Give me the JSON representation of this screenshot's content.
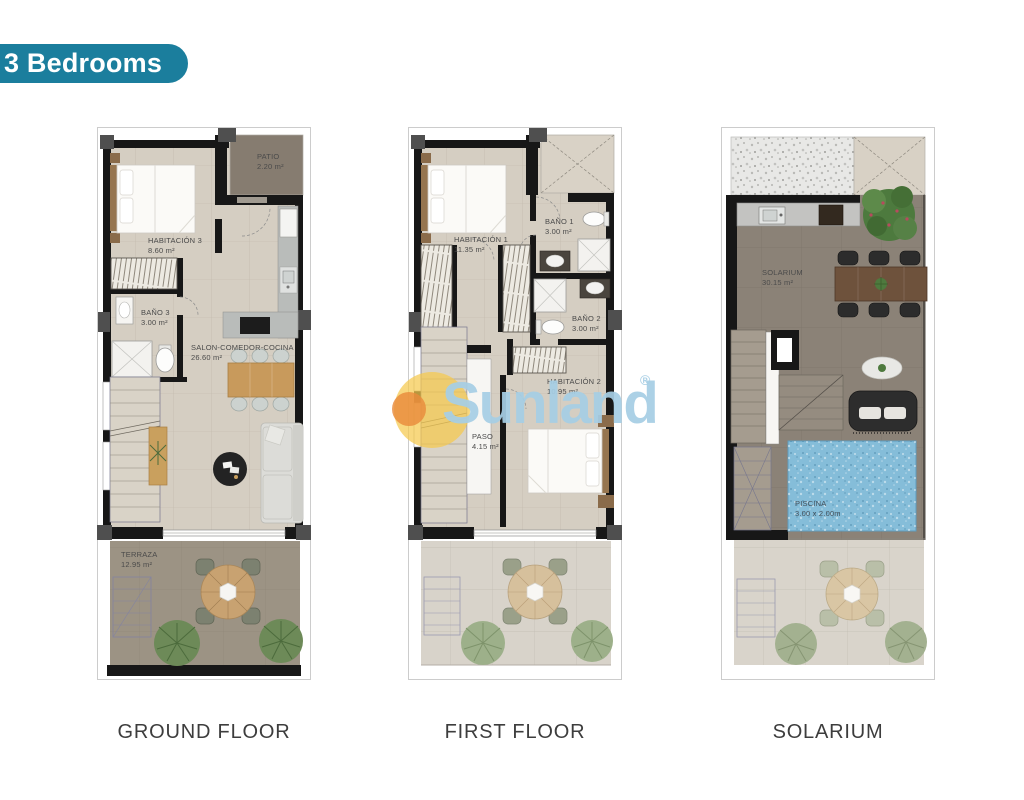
{
  "page": {
    "title_badge": "3 Bedrooms"
  },
  "watermark": {
    "text": "Sunland",
    "registered_mark": "®"
  },
  "colors": {
    "badge": "#1b7e9d",
    "watermark_text": "#a6cee4",
    "logo_yellow": "#f5c94e",
    "logo_orange": "#e98b3c",
    "pool_water": "#85bdd9",
    "wall": "#171717",
    "floor_interior": "#d5cec2",
    "floor_patio": "#867c70",
    "floor_terrace": "#9c9384",
    "floor_solarium": "#8b8277"
  },
  "plans": [
    {
      "id": "ground-floor",
      "caption": "GROUND FLOOR",
      "rooms": [
        {
          "name": "PATIO",
          "area": "2.20 m²"
        },
        {
          "name": "HABITACIÓN 3",
          "area": "8.60 m²"
        },
        {
          "name": "BAÑO 3",
          "area": "3.00 m²"
        },
        {
          "name": "SALON-COMEDOR-COCINA",
          "area": "26.60 m²"
        },
        {
          "name": "TERRAZA",
          "area": "12.95 m²"
        }
      ]
    },
    {
      "id": "first-floor",
      "caption": "FIRST FLOOR",
      "rooms": [
        {
          "name": "HABITACIÓN 1",
          "area": "11.35 m²"
        },
        {
          "name": "BAÑO 1",
          "area": "3.00 m²"
        },
        {
          "name": "BAÑO 2",
          "area": "3.00 m²"
        },
        {
          "name": "HABITACIÓN 2",
          "area": "10.95 m²"
        },
        {
          "name": "PASO",
          "area": "4.15 m²"
        }
      ]
    },
    {
      "id": "solarium",
      "caption": "SOLARIUM",
      "rooms": [
        {
          "name": "SOLARIUM",
          "area": "30.15 m²"
        },
        {
          "name": "PISCINA",
          "area": "3.00 x 2.00m"
        }
      ]
    }
  ]
}
